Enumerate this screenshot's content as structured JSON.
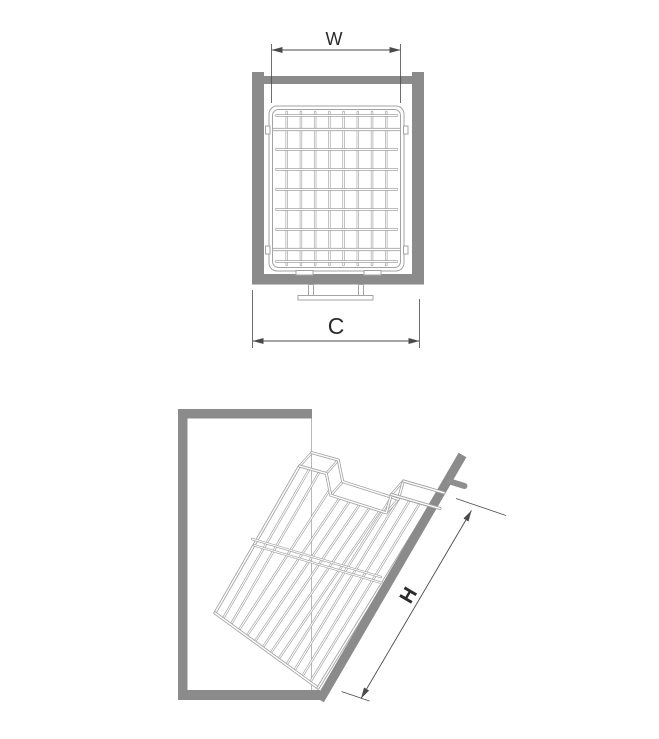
{
  "figures": {
    "front_view": {
      "dimension_labels": {
        "width": "W",
        "overall_width": "C"
      }
    },
    "tilted_view": {
      "dimension_labels": {
        "height": "H"
      }
    }
  },
  "colors": {
    "panel_gray": "#8b8b8b",
    "wire_gray": "#a3a3a3",
    "wire_dark": "#8f8f8f",
    "dimension_line": "#4a4a4a",
    "text_color": "#2b2b2b",
    "projection_line": "#b8b8b8",
    "background": "#ffffff"
  }
}
